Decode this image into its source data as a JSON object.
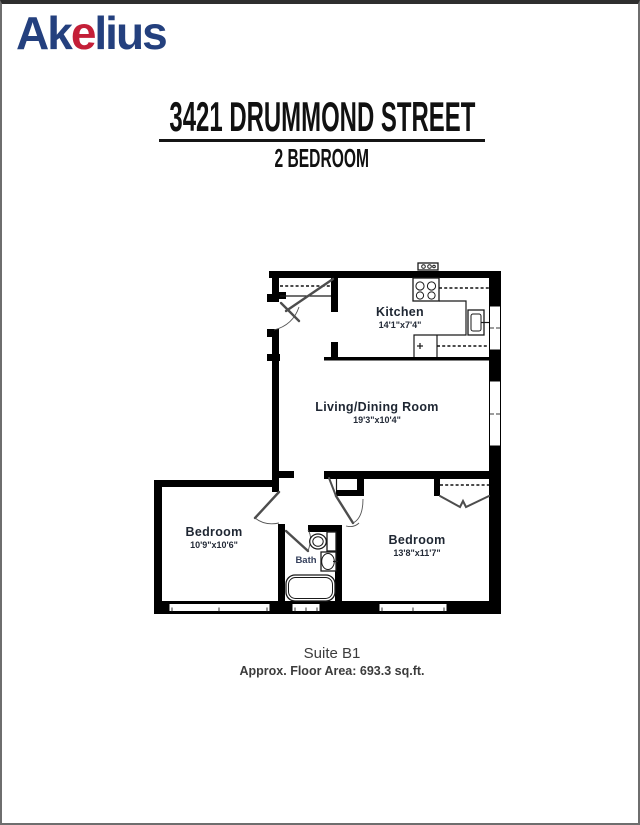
{
  "logo": {
    "prefix": "Ak",
    "accent": "e",
    "suffix": "lius"
  },
  "header": {
    "title": "3421 DRUMMOND STREET",
    "subtitle": "2 BEDROOM"
  },
  "floorplan": {
    "rooms": [
      {
        "name": "Kitchen",
        "dims": "14'1\"x7'4\""
      },
      {
        "name": "Living/Dining Room",
        "dims": "19'3\"x10'4\""
      },
      {
        "name": "Bedroom",
        "dims": "10'9\"x10'6\""
      },
      {
        "name": "Bedroom",
        "dims": "13'8\"x11'7\""
      },
      {
        "name": "Bath",
        "dims": ""
      }
    ]
  },
  "footer": {
    "suite": "Suite B1",
    "area": "Approx. Floor Area: 693.3 sq.ft."
  },
  "colors": {
    "logo_blue": "#24407e",
    "logo_red": "#c41f38",
    "wall": "#000000",
    "label_text": "#1e2632",
    "footer_text": "#3c3c3c",
    "page_border": "#6e6e6e"
  }
}
